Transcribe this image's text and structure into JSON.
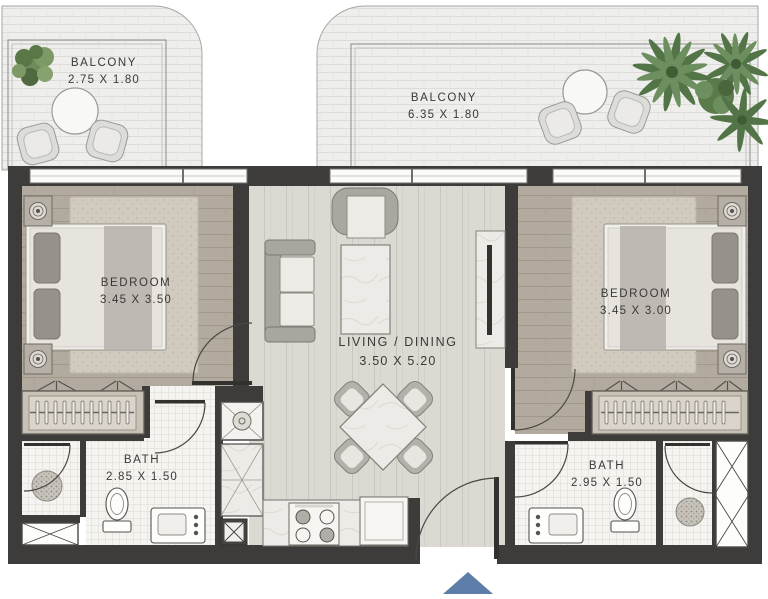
{
  "rooms": {
    "balcony_left": {
      "name": "BALCONY",
      "dims": "2.75 X 1.80"
    },
    "balcony_main": {
      "name": "BALCONY",
      "dims": "6.35 X 1.80"
    },
    "bedroom_left": {
      "name": "BEDROOM",
      "dims": "3.45 X 3.50"
    },
    "living": {
      "name": "LIVING / DINING",
      "dims": "3.50 X 5.20"
    },
    "bedroom_right": {
      "name": "BEDROOM",
      "dims": "3.45 X 3.00"
    },
    "bath_left": {
      "name": "BATH",
      "dims": "2.85 X 1.50"
    },
    "bath_right": {
      "name": "BATH",
      "dims": "2.95 X 1.50"
    }
  },
  "colors": {
    "wall": "#3d3c3a",
    "arrow": "#5e7ca8",
    "floor-living": "#dcd9d3",
    "floor-bedroom": "#b3aa9f",
    "floor-bath": "#f5f4f0",
    "floor-balcony": "#eeeeec"
  }
}
